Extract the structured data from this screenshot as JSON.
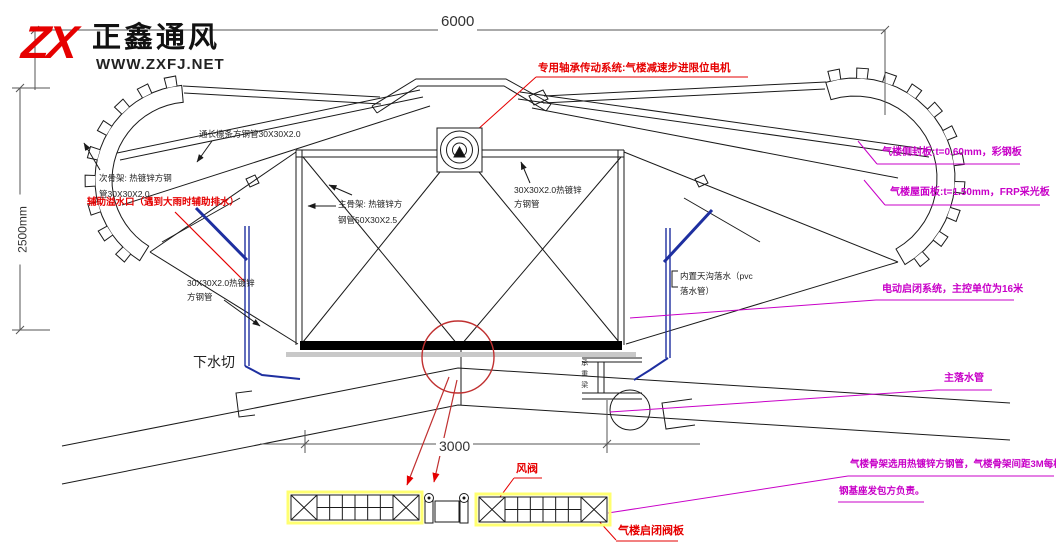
{
  "logo": {
    "mark": "ZX",
    "company": "正鑫通风",
    "website": "WWW.ZXFJ.NET"
  },
  "dimensions": {
    "top_width": "6000",
    "left_height": "2500mm",
    "bottom_width": "3000"
  },
  "colors": {
    "annotation_red": "#e60000",
    "annotation_magenta": "#c800c8",
    "pipe_blue": "#1e2fa0",
    "highlight_yellow": "#ffff70"
  },
  "annotations": {
    "drive_system": "专用轴承传动系统:气楼减速步进限位电机",
    "purlin": "通长檩条方钢管30X30X2.0",
    "secondary_frame": "次骨架: 热镀锌方钢管30X30X2.0",
    "aux_overflow": "辅助溢水口（遇到大雨时辅助排水）",
    "main_frame": "主骨架: 热镀锌方钢管50X30X2.5",
    "tube_right": "30X30X2.0热镀锌方钢管",
    "tube_left": "30X30X2.0热镀锌方钢管",
    "gutter": "内置天沟落水（pvc落水管）",
    "water_cut": "下水切",
    "side_seal_panel": "气楼侧封板:t=0.60mm，彩钢板",
    "roof_sheet_panel": "气楼屋面板:t=1.50mm，FRP采光板",
    "electric_system": "电动启闭系统，主控单位为16米",
    "main_downpipe": "主落水管",
    "frame_note_line1": "气楼骨架选用热镀锌方钢管，气楼骨架间距3M每榀",
    "frame_note_line2": "钢基座发包方负责。",
    "air_valve": "风阀",
    "valve_plate": "气楼启闭阀板",
    "beam": "承重梁"
  }
}
